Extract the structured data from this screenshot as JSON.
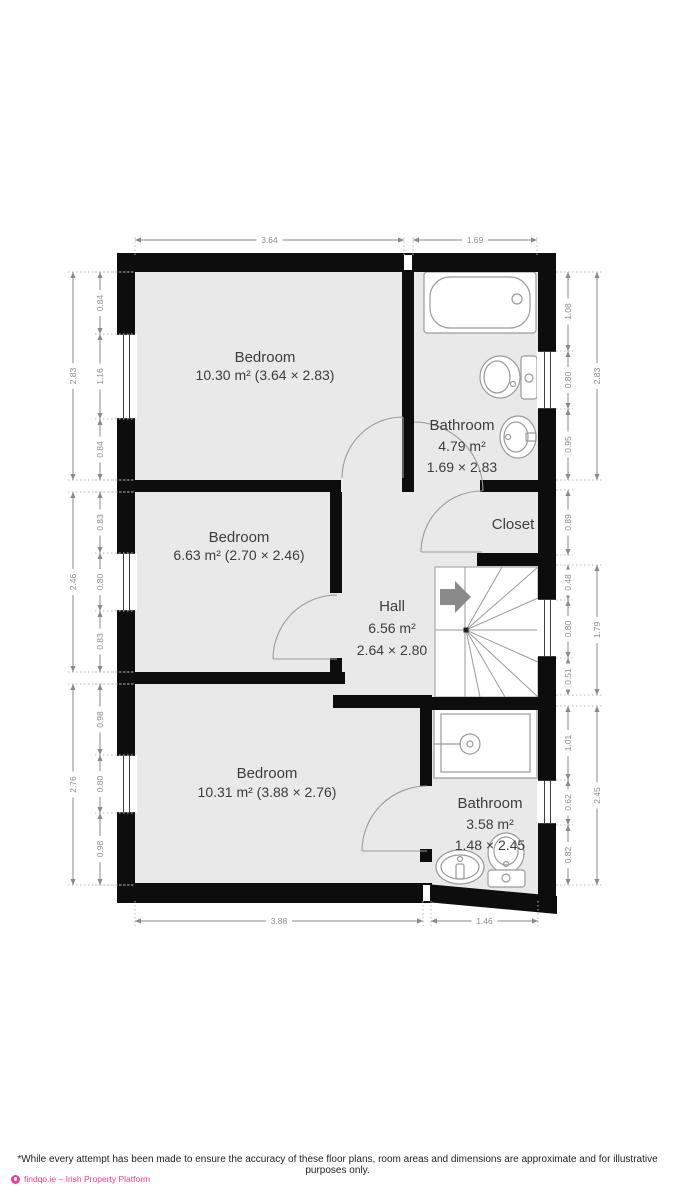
{
  "plan": {
    "rooms": [
      {
        "id": "bedroom-top",
        "name": "Bedroom",
        "area": "10.30 m² (3.64 × 2.83)"
      },
      {
        "id": "bathroom-top",
        "name": "Bathroom",
        "area": "4.79 m²",
        "size": "1.69 × 2.83"
      },
      {
        "id": "bedroom-middle",
        "name": "Bedroom",
        "area": "6.63 m² (2.70 × 2.46)"
      },
      {
        "id": "closet",
        "name": "Closet"
      },
      {
        "id": "hall",
        "name": "Hall",
        "area": "6.56 m²",
        "size": "2.64 × 2.80"
      },
      {
        "id": "bedroom-bottom",
        "name": "Bedroom",
        "area": "10.31 m² (3.88 × 2.76)"
      },
      {
        "id": "bathroom-bottom",
        "name": "Bathroom",
        "area": "3.58 m²",
        "size": "1.48 × 2.45"
      }
    ],
    "dimensions": {
      "top": [
        "3.64",
        "1.69"
      ],
      "bottom": [
        "3.88",
        "1.46"
      ],
      "left_outer": [
        "2.83",
        "2.46",
        "2.76"
      ],
      "left_inner": [
        "0.84",
        "1.16",
        "0.84",
        "0.83",
        "0.80",
        "0.83",
        "0.98",
        "0.80",
        "0.98"
      ],
      "right_inner": [
        "1.08",
        "0.80",
        "0.95",
        "0.89",
        "0.48",
        "0.80",
        "0.51",
        "1.01",
        "0.62",
        "0.82"
      ],
      "right_outer": [
        "2.83",
        "1.79",
        "2.45"
      ]
    }
  },
  "footer": {
    "disclaimer": "*While every attempt has been made to ensure the accuracy of these floor plans, room areas and dimensions are approximate and for illustrative purposes only.",
    "brand": "findqo.ie – Irish Property Platform"
  },
  "colors": {
    "wall": "#0d0d0d",
    "room_fill": "#e9e9e9",
    "fixture_stroke": "#9a9a9a",
    "dimension_gray": "#8a8a8a",
    "label_text": "#3d3d3d",
    "brand_pink": "#ee3d8f"
  }
}
